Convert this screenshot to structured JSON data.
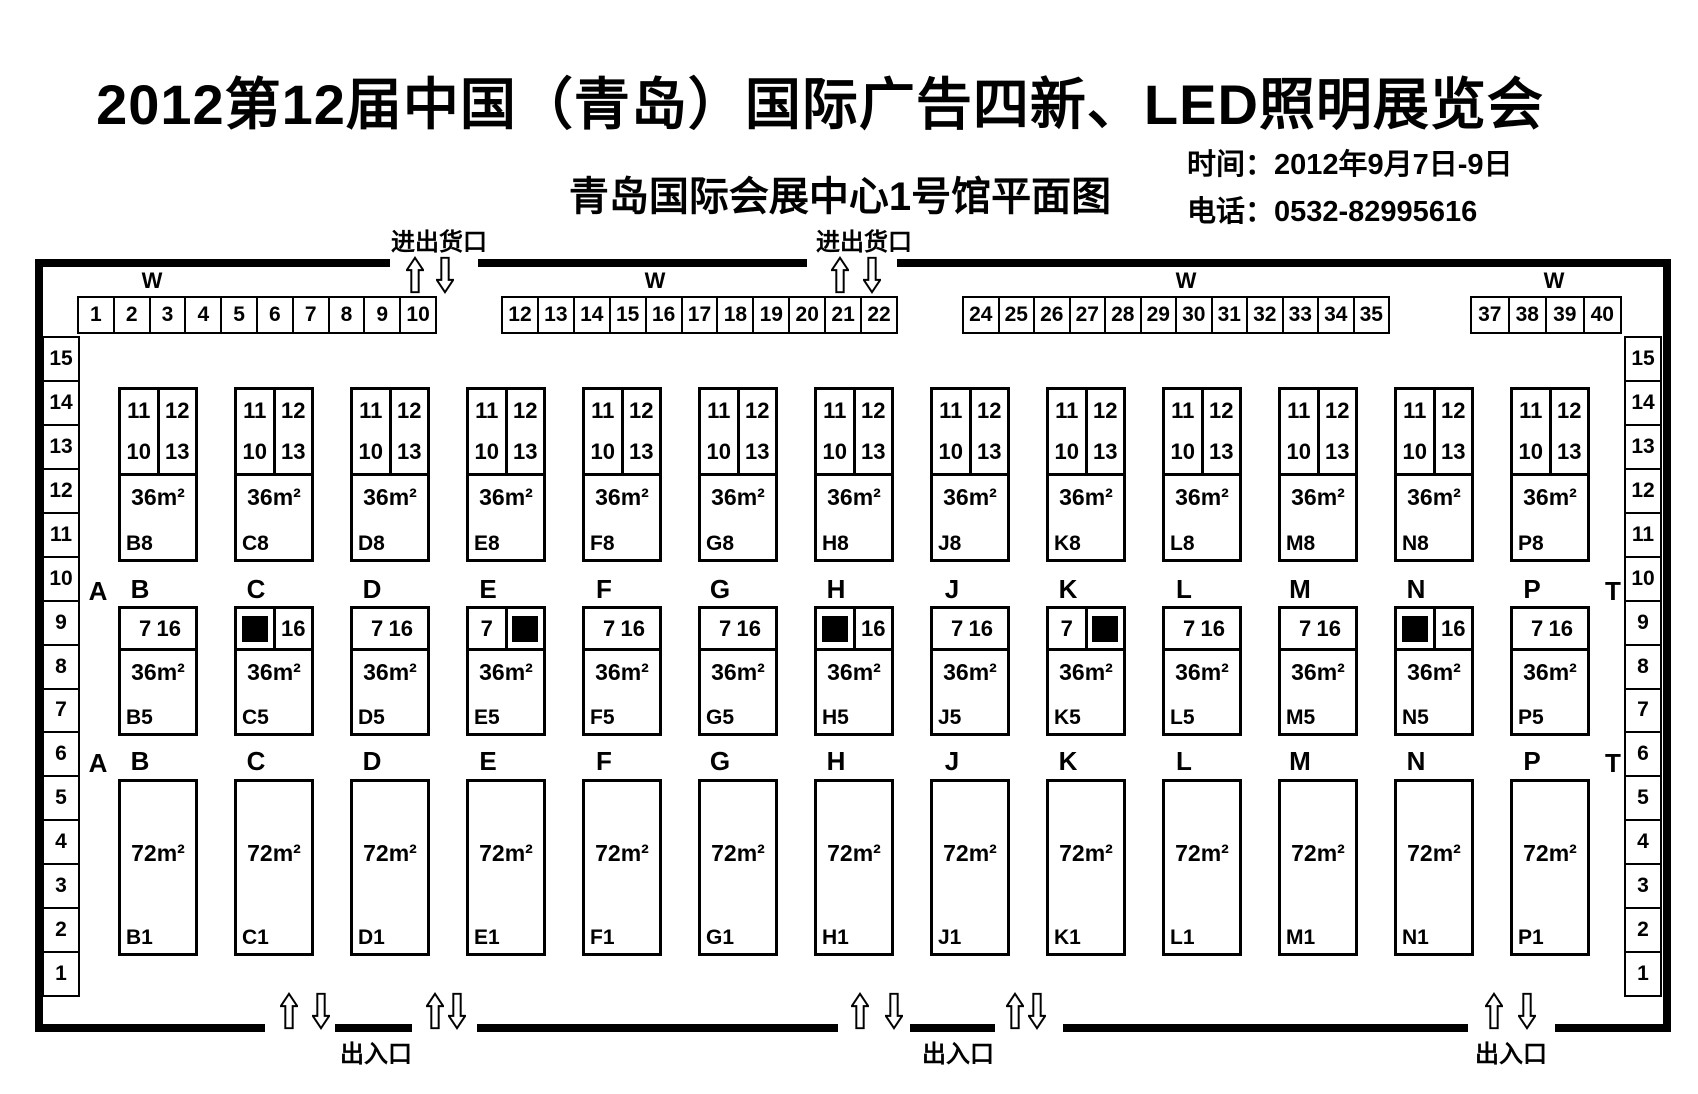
{
  "header": {
    "title": "2012第12届中国（青岛）国际广告四新、LED照明展览会",
    "subtitle": "青岛国际会展中心1号馆平面图",
    "time": "时间：2012年9月7日-9日",
    "phone": "电话：0532-82995616"
  },
  "colors": {
    "line": "#000000",
    "background": "#ffffff",
    "occupied": "#000000"
  },
  "plan": {
    "wall_label": "W",
    "dock_label": "进出货口",
    "exit_label": "出入口",
    "corridor_left": "A",
    "corridor_right": "T",
    "top_booths": [
      [
        "1",
        "2",
        "3",
        "4",
        "5",
        "6",
        "7",
        "8",
        "9",
        "10"
      ],
      [
        "12",
        "13",
        "14",
        "15",
        "16",
        "17",
        "18",
        "19",
        "20",
        "21",
        "22"
      ],
      [
        "24",
        "25",
        "26",
        "27",
        "28",
        "29",
        "30",
        "31",
        "32",
        "33",
        "34",
        "35"
      ],
      [
        "37",
        "38",
        "39",
        "40"
      ]
    ],
    "left_column": [
      "15",
      "14",
      "13",
      "12",
      "11",
      "10",
      "9",
      "8",
      "7",
      "6",
      "5",
      "4",
      "3",
      "2",
      "1"
    ],
    "right_column": [
      "15",
      "14",
      "13",
      "12",
      "11",
      "10",
      "9",
      "8",
      "7",
      "6",
      "5",
      "4",
      "3",
      "2",
      "1"
    ],
    "columns": [
      {
        "letter": "B",
        "top": {
          "left_top": "11",
          "right_top": "12",
          "left_bottom": "10",
          "right_bottom": "13",
          "area": "36m²",
          "label": "B8"
        },
        "mid": {
          "left": "7",
          "right": "16",
          "black": null,
          "area": "36m²",
          "label": "B5"
        },
        "bottom": {
          "area": "72m²",
          "label": "B1"
        }
      },
      {
        "letter": "C",
        "top": {
          "left_top": "11",
          "right_top": "12",
          "left_bottom": "10",
          "right_bottom": "13",
          "area": "36m²",
          "label": "C8"
        },
        "mid": {
          "left": null,
          "right": "16",
          "black": "left",
          "area": "36m²",
          "label": "C5"
        },
        "bottom": {
          "area": "72m²",
          "label": "C1"
        }
      },
      {
        "letter": "D",
        "top": {
          "left_top": "11",
          "right_top": "12",
          "left_bottom": "10",
          "right_bottom": "13",
          "area": "36m²",
          "label": "D8"
        },
        "mid": {
          "left": "7",
          "right": "16",
          "black": null,
          "area": "36m²",
          "label": "D5"
        },
        "bottom": {
          "area": "72m²",
          "label": "D1"
        }
      },
      {
        "letter": "E",
        "top": {
          "left_top": "11",
          "right_top": "12",
          "left_bottom": "10",
          "right_bottom": "13",
          "area": "36m²",
          "label": "E8"
        },
        "mid": {
          "left": "7",
          "right": null,
          "black": "right",
          "area": "36m²",
          "label": "E5"
        },
        "bottom": {
          "area": "72m²",
          "label": "E1"
        }
      },
      {
        "letter": "F",
        "top": {
          "left_top": "11",
          "right_top": "12",
          "left_bottom": "10",
          "right_bottom": "13",
          "area": "36m²",
          "label": "F8"
        },
        "mid": {
          "left": "7",
          "right": "16",
          "black": null,
          "area": "36m²",
          "label": "F5"
        },
        "bottom": {
          "area": "72m²",
          "label": "F1"
        }
      },
      {
        "letter": "G",
        "top": {
          "left_top": "11",
          "right_top": "12",
          "left_bottom": "10",
          "right_bottom": "13",
          "area": "36m²",
          "label": "G8"
        },
        "mid": {
          "left": "7",
          "right": "16",
          "black": null,
          "area": "36m²",
          "label": "G5"
        },
        "bottom": {
          "area": "72m²",
          "label": "G1"
        }
      },
      {
        "letter": "H",
        "top": {
          "left_top": "11",
          "right_top": "12",
          "left_bottom": "10",
          "right_bottom": "13",
          "area": "36m²",
          "label": "H8"
        },
        "mid": {
          "left": null,
          "right": "16",
          "black": "left",
          "area": "36m²",
          "label": "H5"
        },
        "bottom": {
          "area": "72m²",
          "label": "H1"
        }
      },
      {
        "letter": "J",
        "top": {
          "left_top": "11",
          "right_top": "12",
          "left_bottom": "10",
          "right_bottom": "13",
          "area": "36m²",
          "label": "J8"
        },
        "mid": {
          "left": "7",
          "right": "16",
          "black": null,
          "area": "36m²",
          "label": "J5"
        },
        "bottom": {
          "area": "72m²",
          "label": "J1"
        }
      },
      {
        "letter": "K",
        "top": {
          "left_top": "11",
          "right_top": "12",
          "left_bottom": "10",
          "right_bottom": "13",
          "area": "36m²",
          "label": "K8"
        },
        "mid": {
          "left": "7",
          "right": null,
          "black": "right",
          "area": "36m²",
          "label": "K5"
        },
        "bottom": {
          "area": "72m²",
          "label": "K1"
        }
      },
      {
        "letter": "L",
        "top": {
          "left_top": "11",
          "right_top": "12",
          "left_bottom": "10",
          "right_bottom": "13",
          "area": "36m²",
          "label": "L8"
        },
        "mid": {
          "left": "7",
          "right": "16",
          "black": null,
          "area": "36m²",
          "label": "L5"
        },
        "bottom": {
          "area": "72m²",
          "label": "L1"
        }
      },
      {
        "letter": "M",
        "top": {
          "left_top": "11",
          "right_top": "12",
          "left_bottom": "10",
          "right_bottom": "13",
          "area": "36m²",
          "label": "M8"
        },
        "mid": {
          "left": "7",
          "right": "16",
          "black": null,
          "area": "36m²",
          "label": "M5"
        },
        "bottom": {
          "area": "72m²",
          "label": "M1"
        }
      },
      {
        "letter": "N",
        "top": {
          "left_top": "11",
          "right_top": "12",
          "left_bottom": "10",
          "right_bottom": "13",
          "area": "36m²",
          "label": "N8"
        },
        "mid": {
          "left": null,
          "right": "16",
          "black": "left",
          "area": "36m²",
          "label": "N5"
        },
        "bottom": {
          "area": "72m²",
          "label": "N1"
        }
      },
      {
        "letter": "P",
        "top": {
          "left_top": "11",
          "right_top": "12",
          "left_bottom": "10",
          "right_bottom": "13",
          "area": "36m²",
          "label": "P8"
        },
        "mid": {
          "left": "7",
          "right": "16",
          "black": null,
          "area": "36m²",
          "label": "P5"
        },
        "bottom": {
          "area": "72m²",
          "label": "P1"
        }
      }
    ]
  }
}
